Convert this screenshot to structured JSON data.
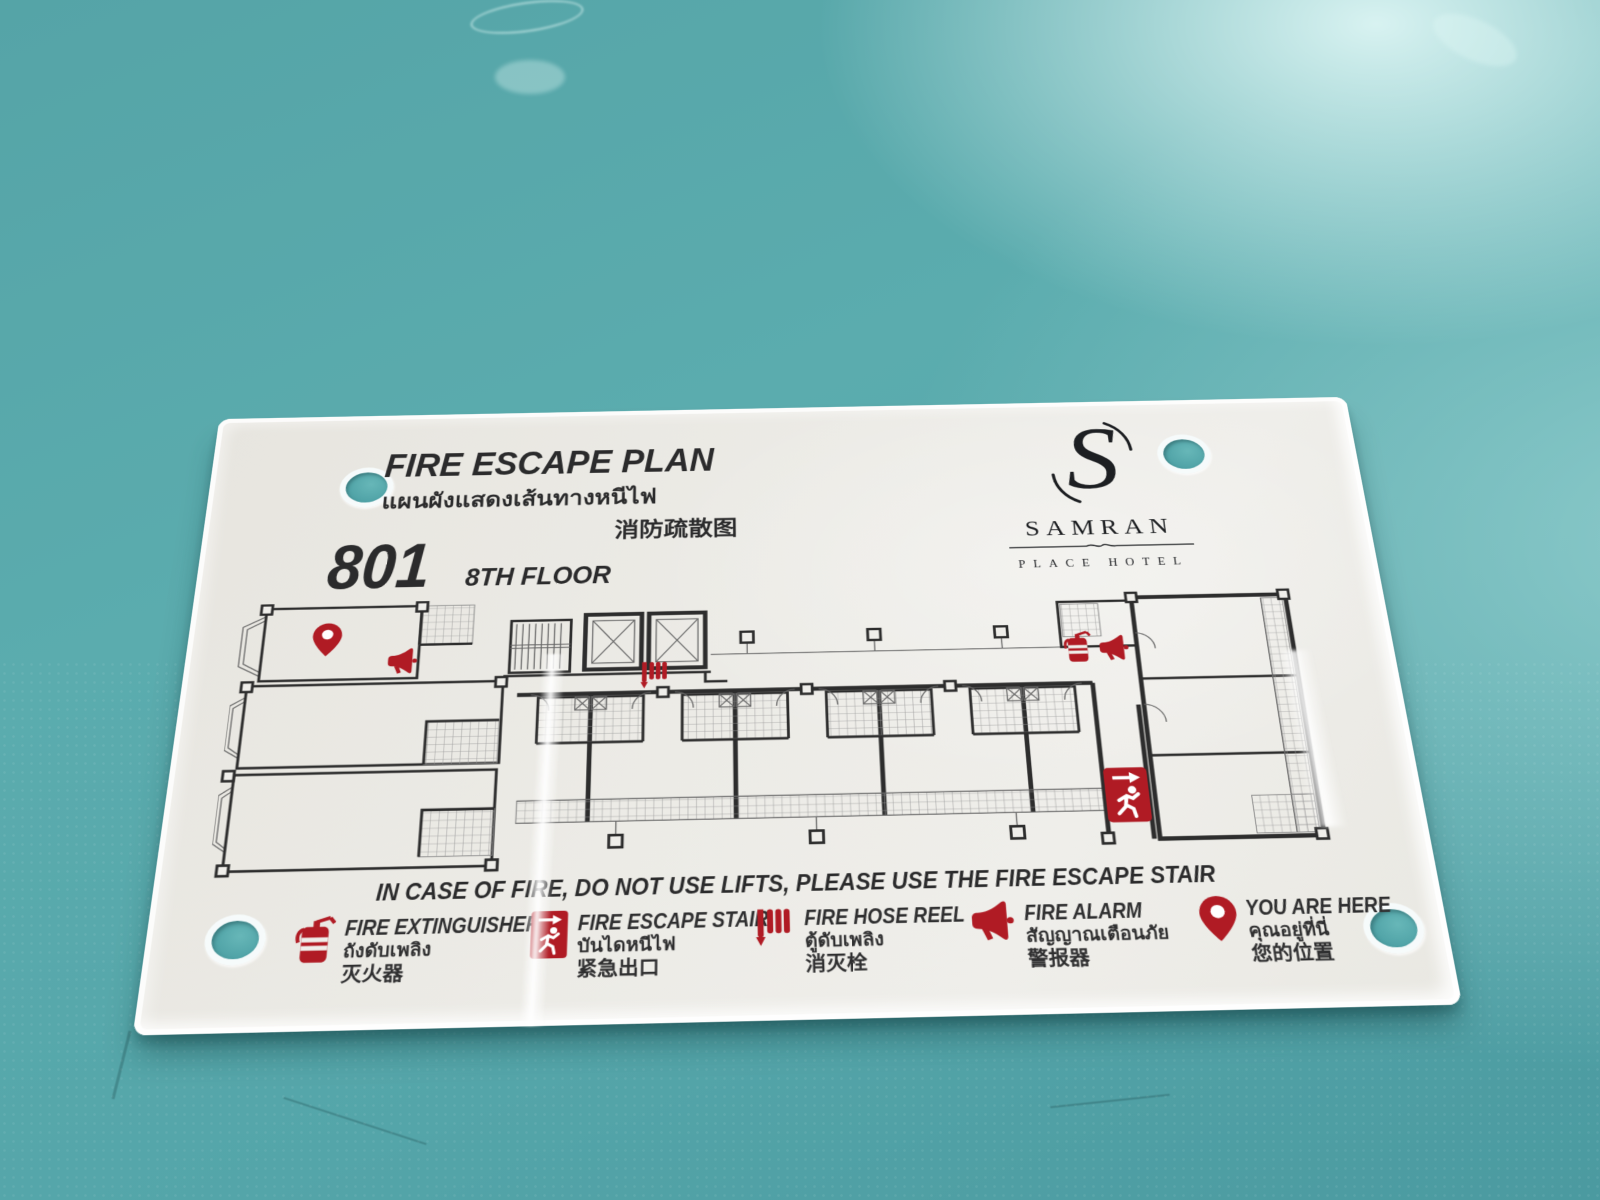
{
  "sign": {
    "title_en": "FIRE ESCAPE PLAN",
    "title_th": "แผนผังแสดงเส้นทางหนีไฟ",
    "title_zh": "消防疏散图",
    "room_number": "801",
    "floor_label": "8TH FLOOR",
    "hotel": {
      "initial": "S",
      "name": "SAMRAN",
      "subtitle": "PLACE HOTEL"
    },
    "warning": "IN CASE OF FIRE, DO NOT USE LIFTS, PLEASE USE THE FIRE ESCAPE STAIR",
    "legend": {
      "items": [
        {
          "icon": "fire-extinguisher-icon",
          "en": "FIRE EXTINGUISHER",
          "th": "ถังดับเพลิง",
          "zh": "灭火器"
        },
        {
          "icon": "fire-escape-stair-icon",
          "en": "FIRE ESCAPE STAIR",
          "th": "บันไดหนีไฟ",
          "zh": "紧急出口"
        },
        {
          "icon": "fire-hose-reel-icon",
          "en": "FIRE HOSE REEL",
          "th": "ตู้ดับเพลิง",
          "zh": "消灭栓"
        },
        {
          "icon": "fire-alarm-icon",
          "en": "FIRE ALARM",
          "th": "สัญญาณเตือนภัย",
          "zh": "警报器"
        },
        {
          "icon": "you-are-here-icon",
          "en": "YOU ARE HERE",
          "th": "คุณอยู่ที่นี่",
          "zh": "您的位置"
        }
      ]
    },
    "floorplan_markers": [
      "you-are-here-pin",
      "fire-alarm",
      "fire-hose-reel",
      "fire-extinguisher",
      "fire-alarm",
      "fire-escape-exit"
    ],
    "colors": {
      "accent_red": "#b01b24",
      "plate": "#e9e7e1",
      "table_teal": "#58a9ac",
      "plan_line": "#2d2d2d",
      "text": "#2b2b2c"
    }
  }
}
